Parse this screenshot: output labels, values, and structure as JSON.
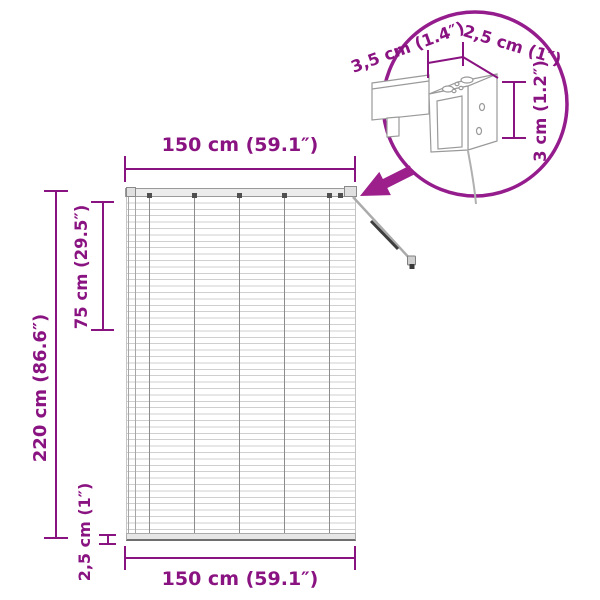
{
  "colors": {
    "dimension": "#8A1382",
    "arrow": "#9C1F8C",
    "circle_stroke": "#951C8C",
    "artwork_gray": "#9a9a9a"
  },
  "dimensions": {
    "top_width": "150 cm (59.1″)",
    "bottom_width": "150 cm (59.1″)",
    "total_height": "220 cm (86.6″)",
    "upper_section_height": "75 cm (29.5″)",
    "bottom_rail_height": "2,5 cm (1″)"
  },
  "detail_view": {
    "bracket_depth": "3,5 cm (1.4″)",
    "bracket_width": "2,5 cm (1″)",
    "bracket_height": "3 cm (1.2″)"
  }
}
